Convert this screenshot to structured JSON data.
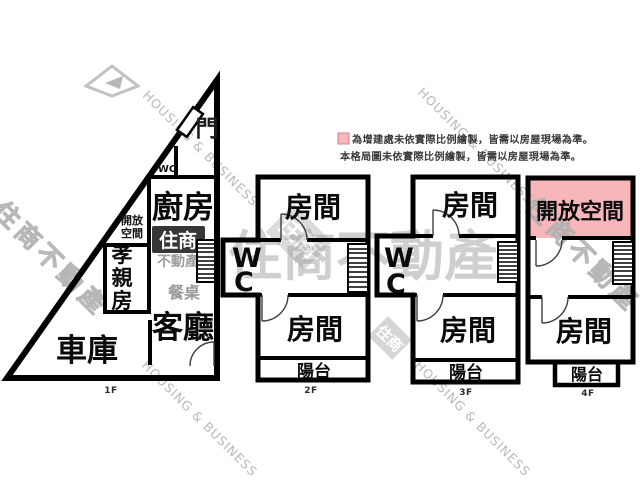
{
  "legend": {
    "note_line1": "為增建處未依實際比例繪製，皆需以房屋現場為準。",
    "note_line2": "本格局圖未依實際比例繪製，皆需以房屋現場為準。"
  },
  "floor1": {
    "label": "1F",
    "door": "門",
    "wc": "WC",
    "kitchen": "廚房",
    "open_space_line1": "開放",
    "open_space_line2": "空間",
    "parents_char1": "孝",
    "parents_char2": "親",
    "parents_char3": "房",
    "dining_table": "餐桌",
    "living_room": "客廳",
    "garage": "車庫"
  },
  "floor2": {
    "label": "2F",
    "room_top": "房間",
    "wc_line1": "W",
    "wc_line2": "C",
    "room_bottom": "房間",
    "balcony": "陽台"
  },
  "floor3": {
    "label": "3F",
    "room_top": "房間",
    "wc_line1": "W",
    "wc_line2": "C",
    "room_bottom": "房間",
    "balcony": "陽台"
  },
  "floor4": {
    "label": "4F",
    "open_space": "開放空間",
    "room": "房間",
    "balcony": "陽台"
  },
  "watermarks": {
    "brand_en": "HOUSING & BUSINESS",
    "brand_zh": "住商不動產",
    "logo_primary": "住商",
    "logo_secondary": "不動產"
  },
  "colors": {
    "wall": "#000000",
    "addition_fill": "#f6b6ba",
    "addition_border": "#c9858d",
    "watermark_gray": "#a0a0a0"
  }
}
